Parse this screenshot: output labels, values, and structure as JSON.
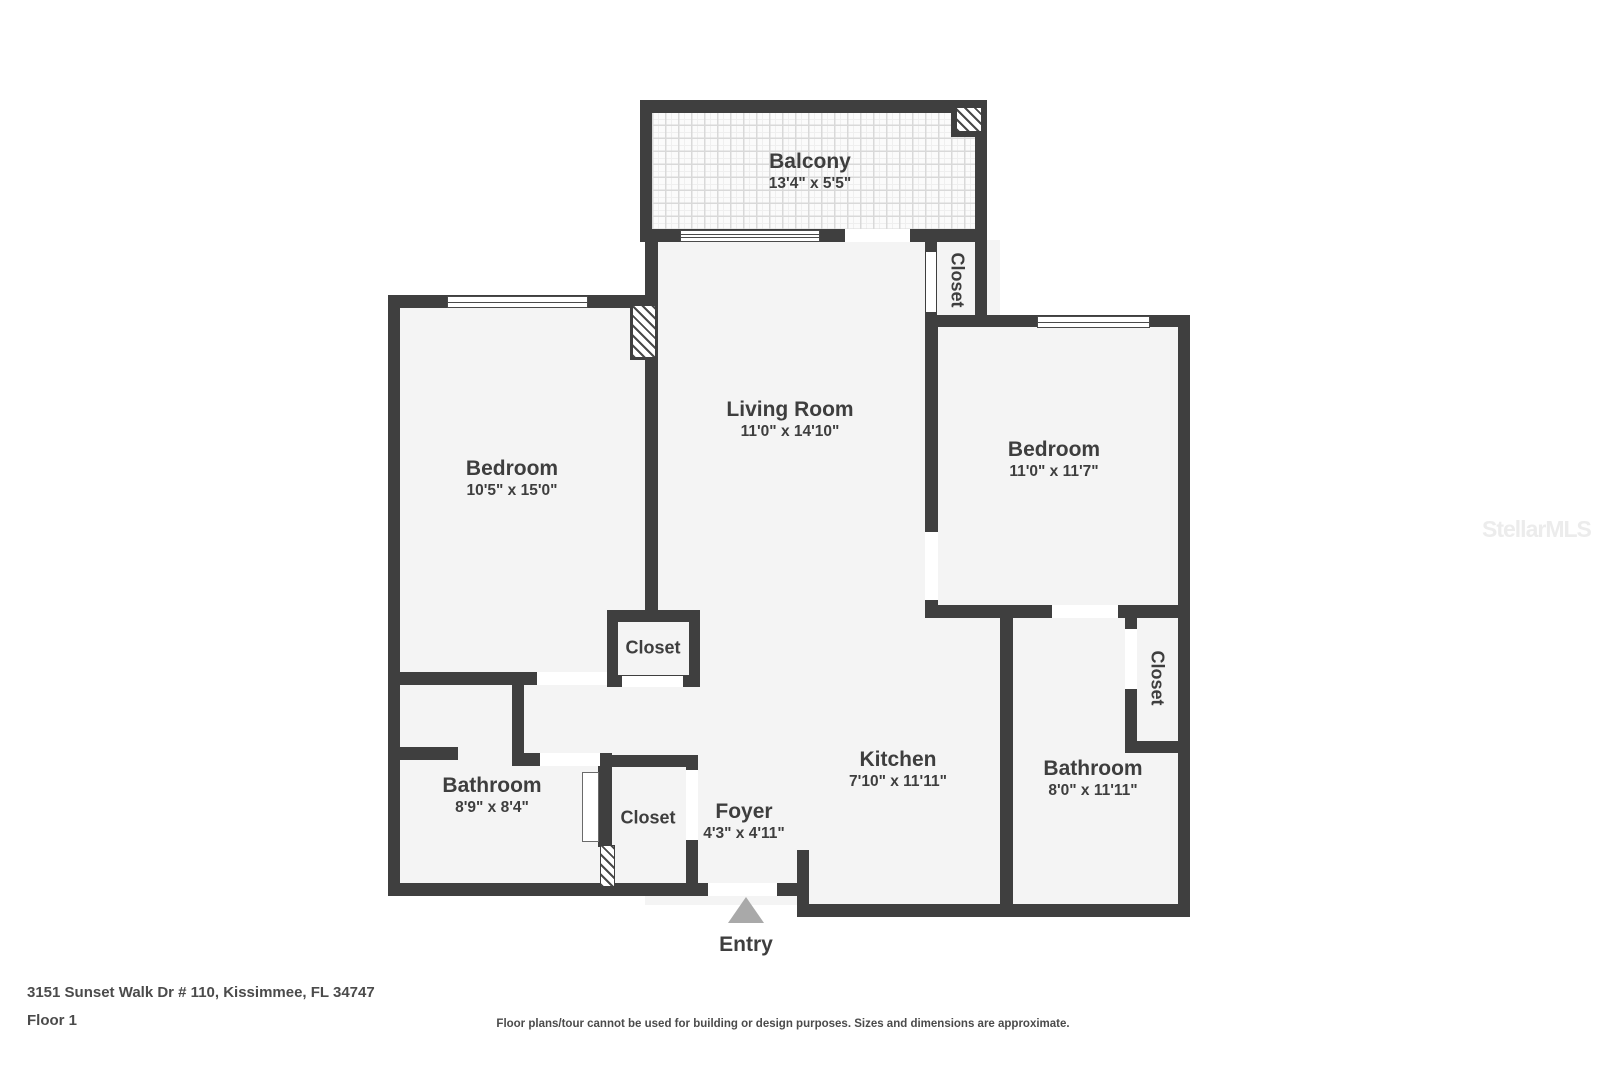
{
  "floorplan": {
    "rooms": {
      "balcony": {
        "name": "Balcony",
        "dims": "13'4\" x 5'5\""
      },
      "living": {
        "name": "Living Room",
        "dims": "11'0\" x 14'10\""
      },
      "bedroom_left": {
        "name": "Bedroom",
        "dims": "10'5\" x 15'0\""
      },
      "bedroom_right": {
        "name": "Bedroom",
        "dims": "11'0\" x 11'7\""
      },
      "kitchen": {
        "name": "Kitchen",
        "dims": "7'10\" x 11'11\""
      },
      "bathroom_left": {
        "name": "Bathroom",
        "dims": "8'9\" x 8'4\""
      },
      "bathroom_right": {
        "name": "Bathroom",
        "dims": "8'0\" x 11'11\""
      },
      "foyer": {
        "name": "Foyer",
        "dims": "4'3\" x 4'11\""
      },
      "closet_top": {
        "name": "Closet"
      },
      "closet_mid": {
        "name": "Closet"
      },
      "closet_right": {
        "name": "Closet"
      },
      "closet_foyer": {
        "name": "Closet"
      },
      "entry": {
        "name": "Entry"
      }
    },
    "footer": {
      "address": "3151 Sunset Walk Dr # 110, Kissimmee, FL 34747",
      "floor": "Floor 1",
      "disclaimer": "Floor plans/tour cannot be used for building or design purposes. Sizes and dimensions are approximate."
    },
    "watermark": "StellarMLS",
    "colors": {
      "wall": "#3f3f3f",
      "room_fill": "#f4f4f4",
      "text": "#3e3e3e",
      "entry_arrow": "#a9a9a9"
    },
    "icons": {
      "entry_marker": "entry-arrow-icon",
      "balcony_unit": "ac-unit-icon"
    }
  }
}
